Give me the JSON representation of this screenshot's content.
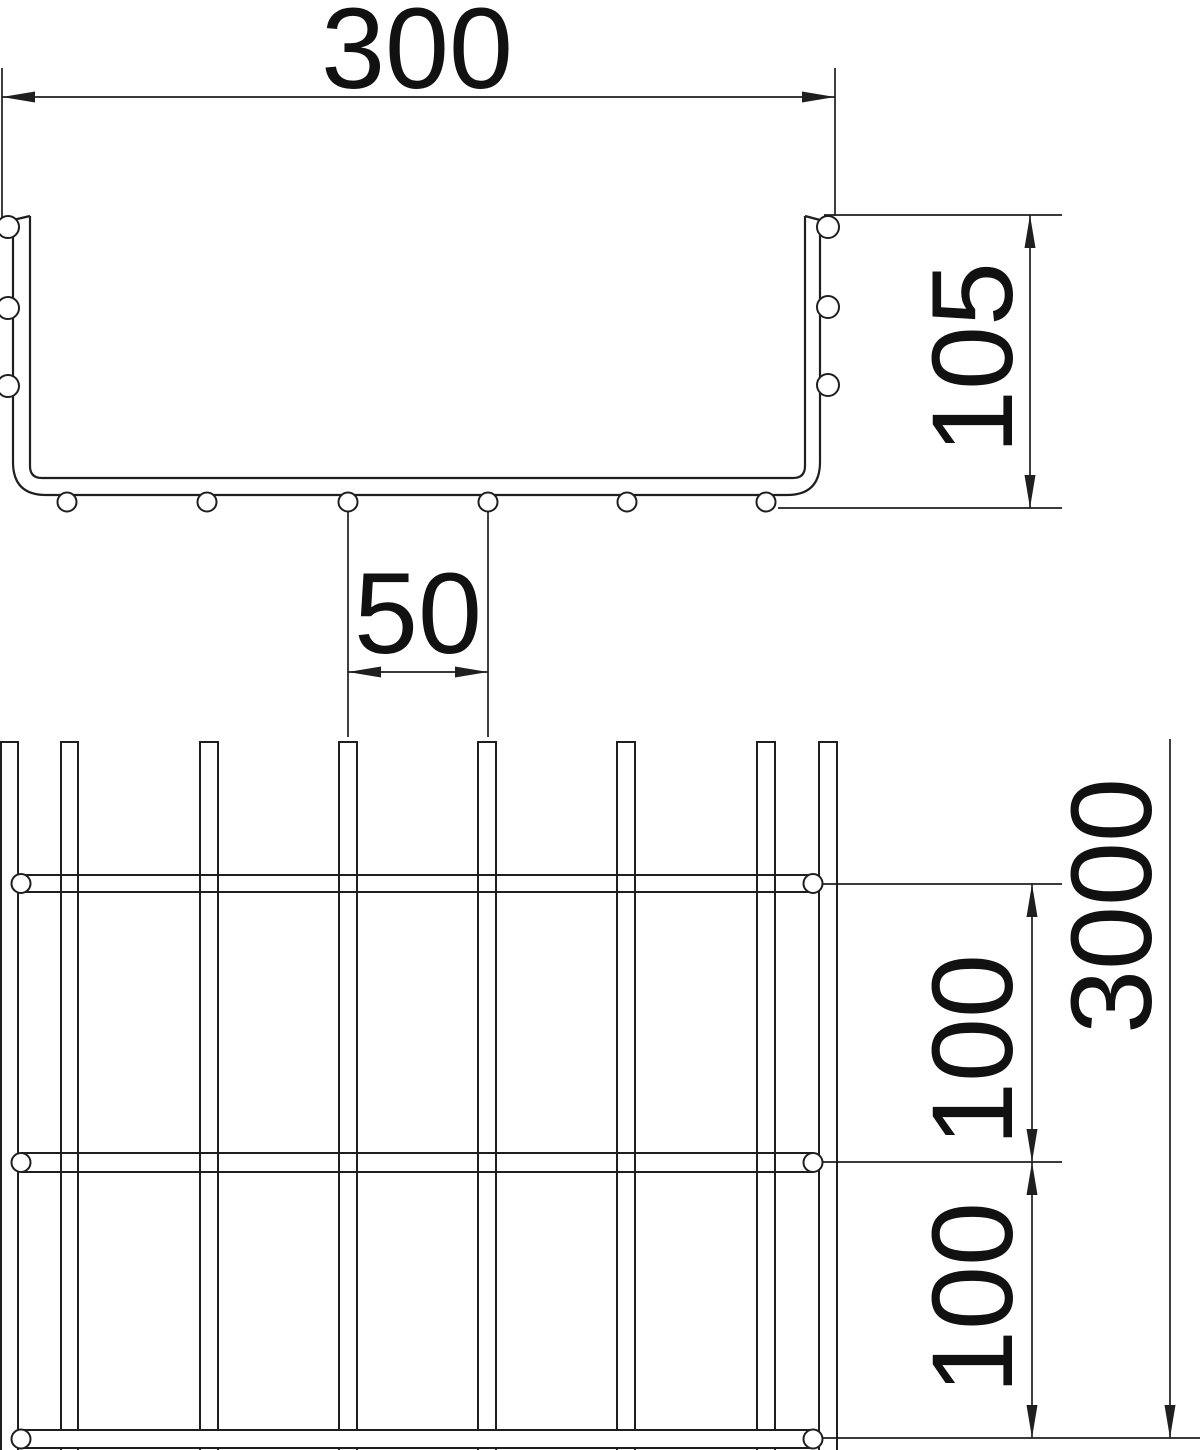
{
  "page": {
    "background_color": "#ffffff",
    "line_color": "#1f1f1f"
  },
  "views": {
    "cross_section": {
      "width_label": "300",
      "height_label": "105",
      "bottom_wire_spacing_label": "50"
    },
    "plan": {
      "length_label": "3000",
      "crosswire_pitch_label_upper": "100",
      "crosswire_pitch_label_lower": "100"
    }
  }
}
